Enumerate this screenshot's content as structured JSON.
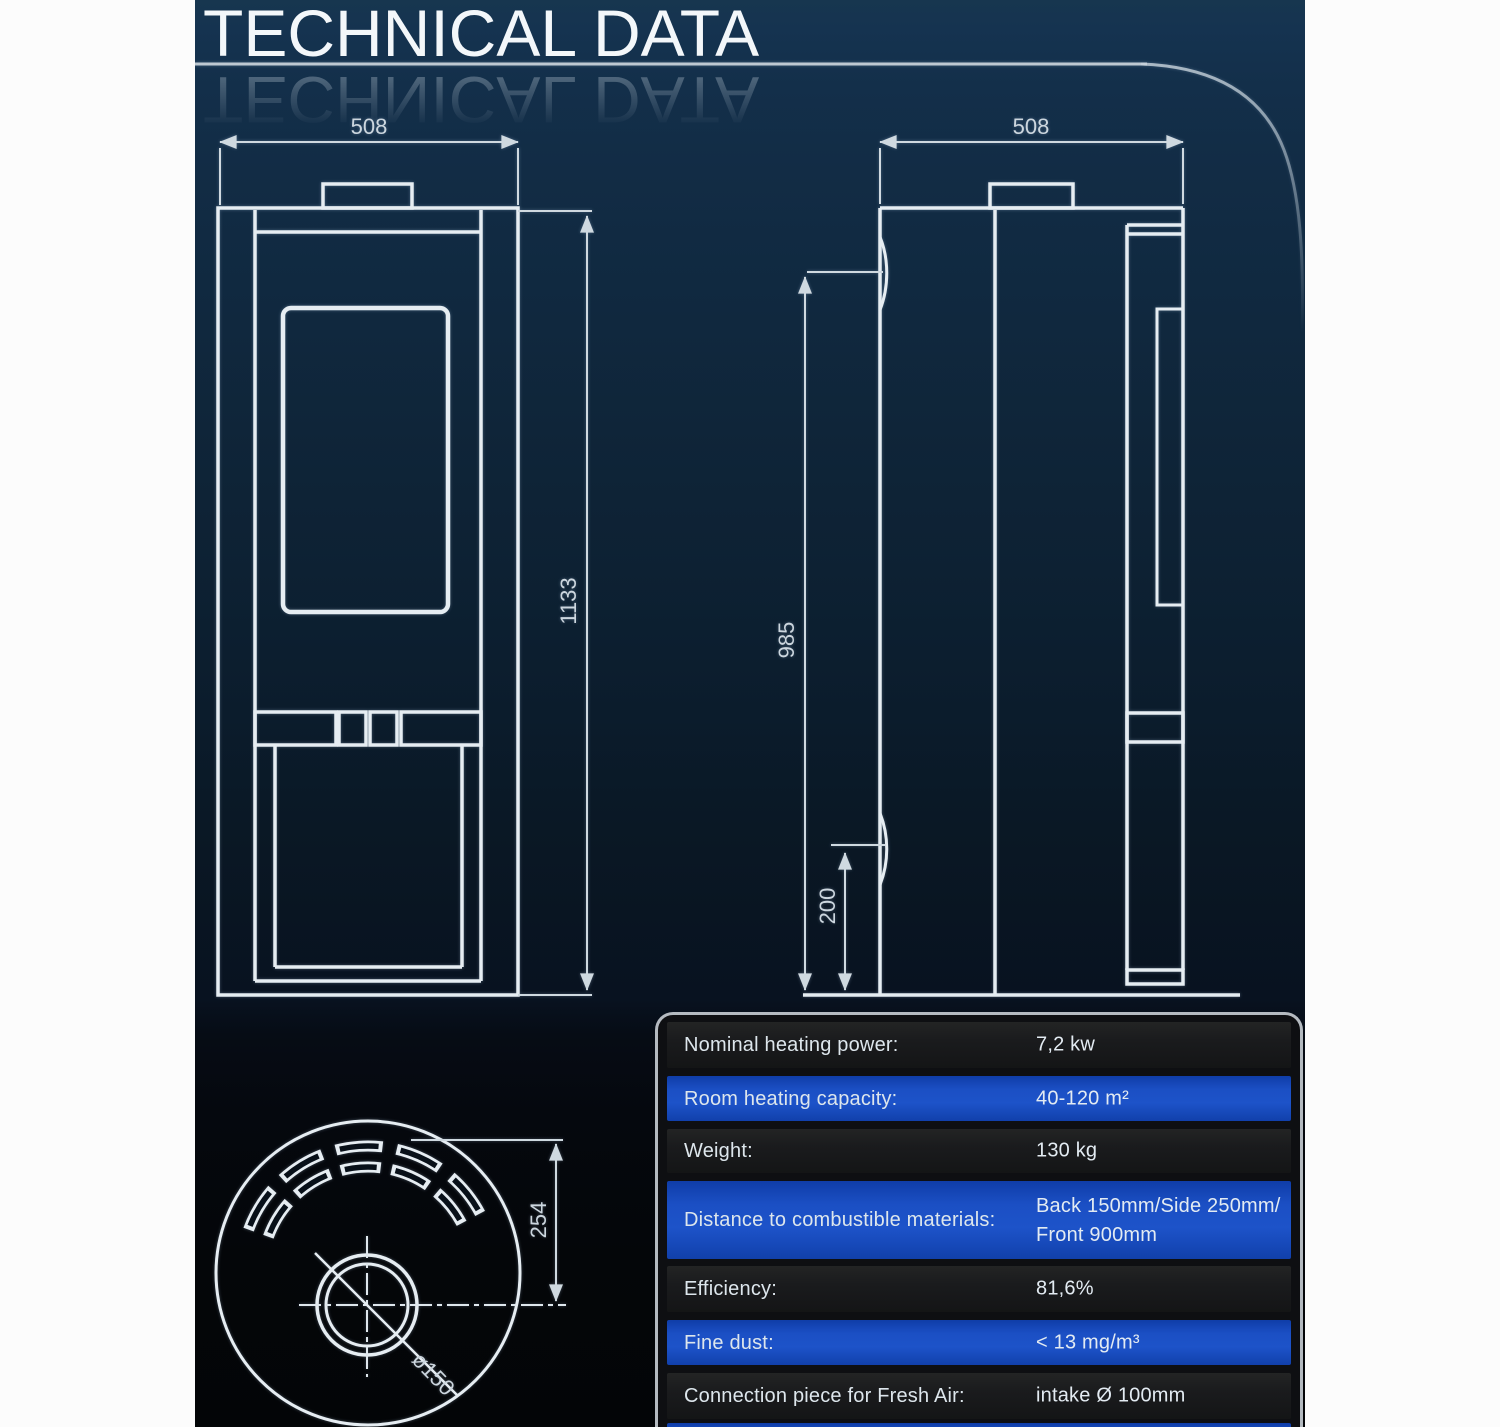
{
  "title": {
    "text": "TECHNICAL DATA"
  },
  "colors": {
    "page_margin": "#fcfcfc",
    "panel_top": "#17364f",
    "panel_bottom": "#030507",
    "drawing_line": "#e6edf2",
    "dimension_line": "#cfd9e0",
    "table_row_blue": "#1b4fc4",
    "table_row_dark": "#1a1b1d",
    "table_border": "#b4bac0"
  },
  "drawings": {
    "front_view": {
      "width_mm": "508",
      "height_mm": "1133"
    },
    "side_view": {
      "depth_mm": "508",
      "body_height_mm": "985",
      "base_height_mm": "200"
    },
    "top_view": {
      "flue_offset_mm": "254",
      "flue_diameter": "ø150"
    }
  },
  "table": {
    "rows": [
      {
        "label": "Nominal heating power:",
        "value": "7,2 kw"
      },
      {
        "label": "Room heating capacity:",
        "value": "40-120 m²"
      },
      {
        "label": "Weight:",
        "value": "130 kg"
      },
      {
        "label": "Distance to combustible materials:",
        "value": "Back 150mm/Side 250mm/",
        "value2": "Front 900mm"
      },
      {
        "label": "Efficiency:",
        "value": "81,6%"
      },
      {
        "label": "Fine dust:",
        "value": "< 13 mg/m³"
      },
      {
        "label": "Connection piece for Fresh Air:",
        "value": "intake Ø 100mm"
      }
    ]
  }
}
